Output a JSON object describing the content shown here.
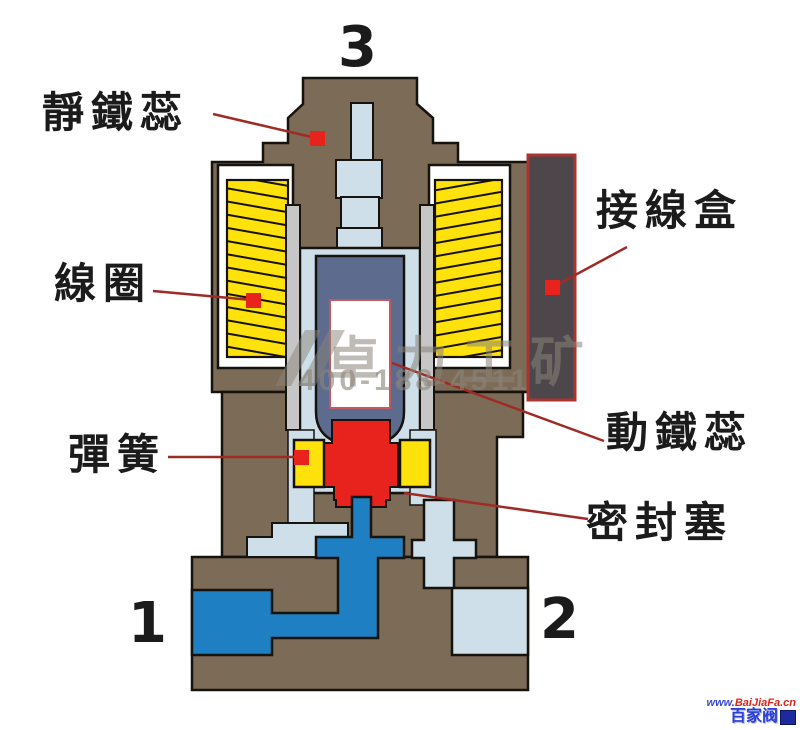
{
  "diagram": {
    "type": "solenoid-valve-cross-section",
    "port_numbers": {
      "top": "3",
      "bottom_left": "1",
      "bottom_right": "2"
    },
    "labels": {
      "static_core": "靜鐵蕊",
      "coil": "線圈",
      "spring": "彈簧",
      "junction_box": "接線盒",
      "moving_core": "動鐵蕊",
      "seal_plug": "密封塞"
    },
    "watermark": {
      "line1": "卓力工矿",
      "line2": "400-188-4511"
    },
    "logo": {
      "url_prefix": "www.",
      "url_brand": "BaiJiaFa",
      "url_suffix": ".cn",
      "brand_cn": "百家阀"
    },
    "colors": {
      "body_brown": "#7c6b56",
      "outline_black": "#16120d",
      "coil_yellow": "#ffe10c",
      "spring_yellow": "#ffe10c",
      "light_blue": "#cfdfea",
      "fluid_blue": "#1e7fc2",
      "core_slate": "#5c6b8e",
      "tube_gray": "#c6c6c7",
      "seal_red": "#e8231d",
      "junction_box_gray": "#4d474b",
      "junction_box_border_red": "#ab3430",
      "leader_line_red": "#9e2b26"
    }
  }
}
